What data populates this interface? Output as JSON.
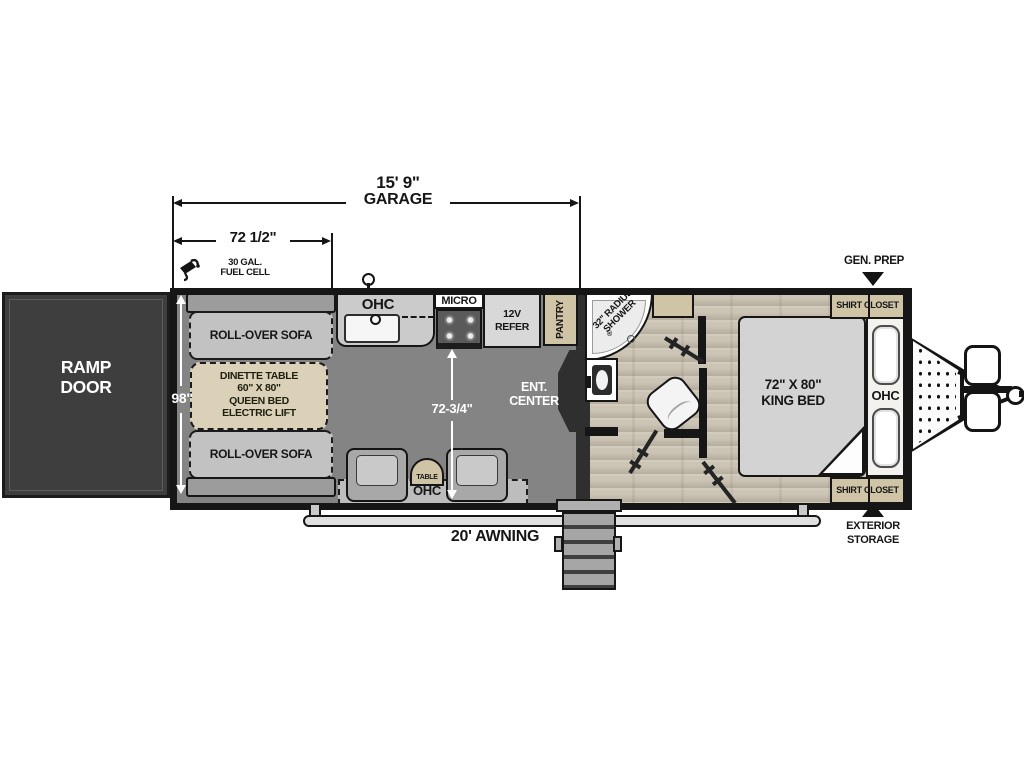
{
  "dims": {
    "garage_length": "15' 9\"",
    "garage_word": "GARAGE",
    "front": "72 1/2\"",
    "body_width": "98\"",
    "living_width": "72-3/4\""
  },
  "exterior": {
    "fuel1": "30 GAL.",
    "fuel2": "FUEL CELL",
    "awning": "20' AWNING",
    "gen_prep": "GEN. PREP",
    "storage1": "EXTERIOR",
    "storage2": "STORAGE"
  },
  "garage": {
    "ramp1": "RAMP",
    "ramp2": "DOOR",
    "sofa_top": "ROLL-OVER SOFA",
    "sofa_bottom": "ROLL-OVER SOFA",
    "dinette1": "DINETTE TABLE",
    "dinette2": "60\" X 80\"",
    "dinette3": "QUEEN BED",
    "dinette4": "ELECTRIC LIFT"
  },
  "kitchen": {
    "ohc": "OHC",
    "micro": "MICRO",
    "refer1": "12V",
    "refer2": "REFER",
    "pantry": "PANTRY"
  },
  "living": {
    "ent1": "ENT.",
    "ent2": "CENTER",
    "table": "TABLE",
    "ohc": "OHC"
  },
  "bath": {
    "shower1": "32\" RADIUS",
    "shower2": "SHOWER",
    "reg": "®"
  },
  "bedroom": {
    "bed1": "72\" X 80\"",
    "bed2": "KING BED",
    "ohc": "OHC",
    "closet_top": "SHIRT CLOSET",
    "closet_bottom": "SHIRT CLOSET"
  },
  "colors": {
    "wall": "#161616",
    "garage_floor": "#848484",
    "wood_floor": "#ccc5b6",
    "tan": "#cfc4a6",
    "ramp_door": "#3e3e3e",
    "furniture_gray": "#c2c2c2"
  }
}
